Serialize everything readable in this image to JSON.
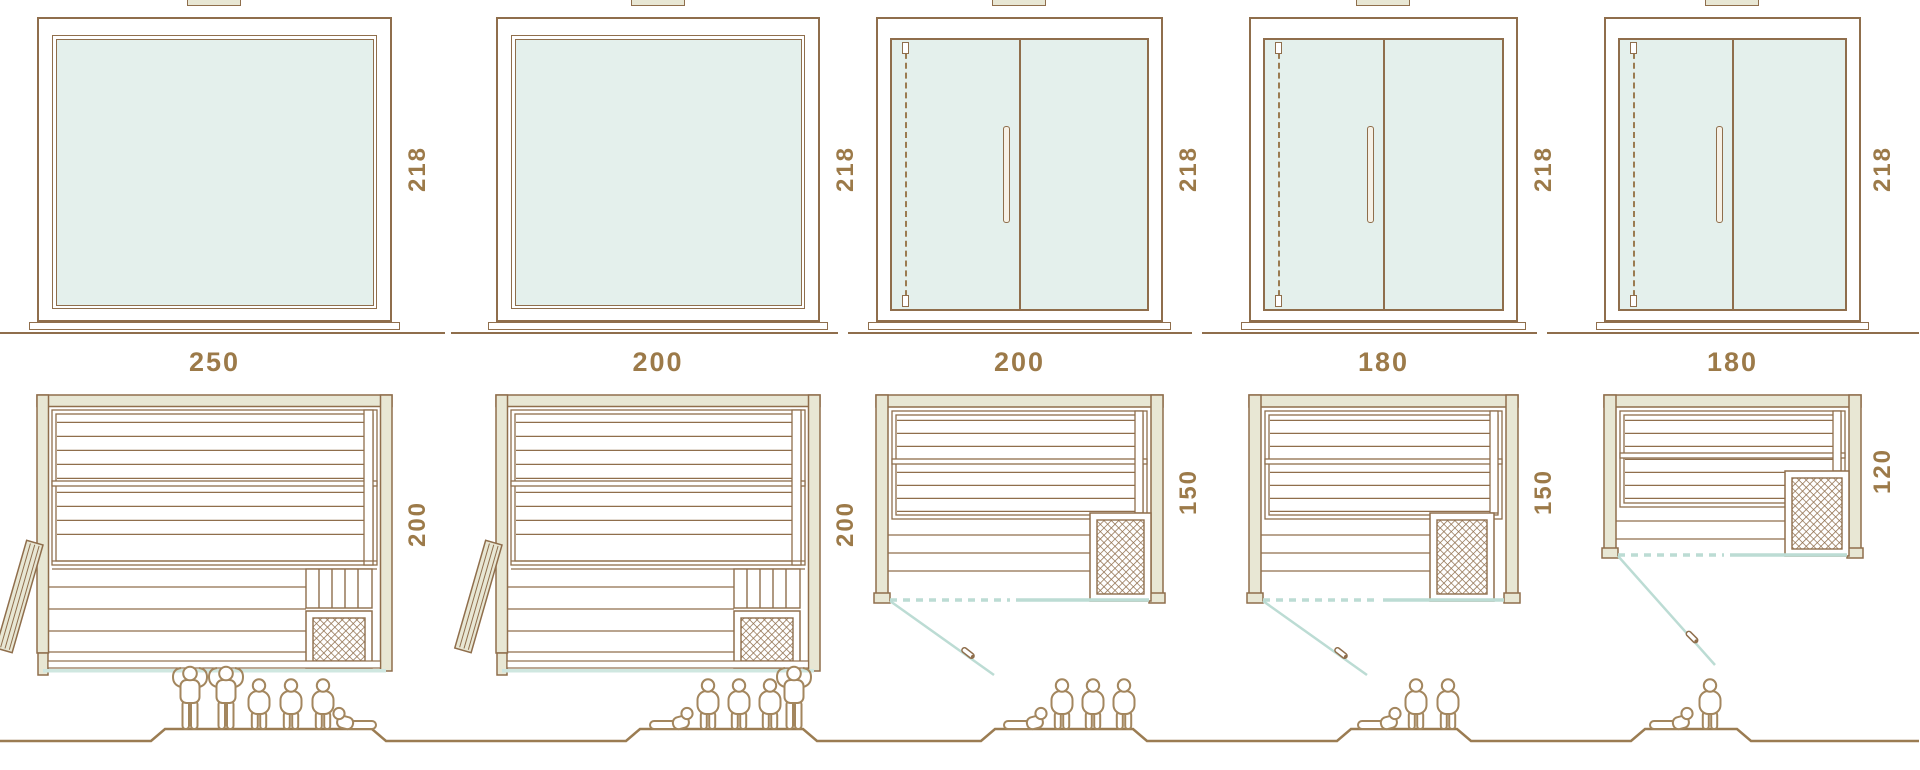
{
  "diagram": {
    "kind": "sauna-size-comparison",
    "rows": [
      "front-elevation",
      "width-dimension",
      "floor-plan",
      "capacity-figures"
    ]
  },
  "colors": {
    "line_brown": "#8f6e4c",
    "wall_beige": "#e8e7d4",
    "glass_teal": "#e4f0ec",
    "door_swing_teal": "#bcdcd4",
    "label_brown": "#9c7a49",
    "people_brown": "#a3865e"
  },
  "columns": [
    {
      "width": "250",
      "depth": "200",
      "height": "218",
      "front_type": "fixed-glass-panel",
      "door_type": "side-door-open",
      "people": [
        "standing",
        "standing",
        "sitting",
        "sitting",
        "sitting",
        "lying"
      ]
    },
    {
      "width": "200",
      "depth": "200",
      "height": "218",
      "front_type": "fixed-glass-panel",
      "door_type": "side-door-open",
      "people": [
        "lying",
        "sitting",
        "sitting",
        "sitting",
        "standing"
      ]
    },
    {
      "width": "200",
      "depth": "150",
      "height": "218",
      "front_type": "double-glass-panel",
      "door_type": "front-hinged-glass-door",
      "people": [
        "lying",
        "sitting",
        "sitting",
        "sitting"
      ]
    },
    {
      "width": "180",
      "depth": "150",
      "height": "218",
      "front_type": "double-glass-panel",
      "door_type": "front-hinged-glass-door",
      "people": [
        "lying",
        "sitting",
        "sitting"
      ]
    },
    {
      "width": "180",
      "depth": "120",
      "height": "218",
      "front_type": "double-glass-panel",
      "door_type": "front-hinged-glass-door",
      "people": [
        "lying",
        "sitting"
      ]
    }
  ]
}
